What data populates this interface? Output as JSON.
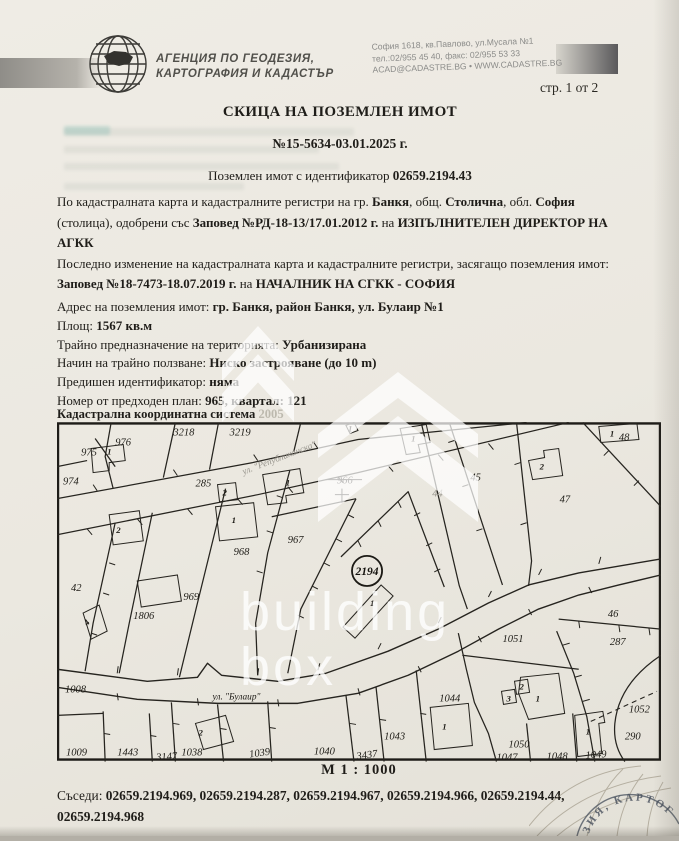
{
  "header": {
    "agency_line1": "АГЕНЦИЯ ПО ГЕОДЕЗИЯ,",
    "agency_line2": "КАРТОГРАФИЯ И КАДАСТЪР",
    "address_line1": "София 1618, кв.Павлово, ул.Мусала №1",
    "address_line2": "тел.:02/955 45 40, факс: 02/955 53 33",
    "address_line3": "ACAD@CADASTRE.BG • WWW.CADASTRE.BG",
    "page_indicator": "стр. 1 от 2"
  },
  "title": {
    "main": "СКИЦА НА ПОЗЕМЛЕН ИМОТ",
    "number": "№15-5634-03.01.2025 г.",
    "id_label": "Поземлен имот с идентификатор ",
    "id_value": "02659.2194.43"
  },
  "details": {
    "p1": [
      {
        "t": "По кадастралната карта и кадастралните регистри на гр. "
      },
      {
        "t": "Банкя"
      },
      {
        "t": ", общ. "
      },
      {
        "t": "Столична"
      },
      {
        "t": ", обл. "
      },
      {
        "t": "София"
      },
      {
        "t": " (столица), одобрени със "
      },
      {
        "t": "Заповед №РД-18-13/17.01.2012 г."
      },
      {
        "t": " на "
      },
      {
        "t": "ИЗПЪЛНИТЕЛЕН ДИРЕКТОР НА АГКК"
      }
    ],
    "p2": [
      {
        "t": "Последно изменение на кадастралната карта и кадастралните регистри, засягащо поземления имот: "
      },
      {
        "t": "Заповед №18-7473-18.07.2019 г."
      },
      {
        "t": " на "
      },
      {
        "t": "НАЧАЛНИК НА СГКК - СОФИЯ"
      }
    ],
    "rows": [
      {
        "label": "Адрес на поземления имот: ",
        "value": "гр. Банкя, район Банкя, ул. Булаир №1"
      },
      {
        "label": "Площ: ",
        "value": "1567 кв.м"
      },
      {
        "label": "Трайно предназначение на територията: ",
        "value": "Урбанизирана"
      },
      {
        "label": "Начин на трайно ползване: ",
        "value": "Ниско застрояване (до 10 m)"
      },
      {
        "label": "Предишен идентификатор: ",
        "value": "няма"
      },
      {
        "label": "Номер от предходен план: ",
        "value": "965, квартал: 121"
      }
    ]
  },
  "map": {
    "coord_system_label": "Кадастрална координатна система ",
    "coord_system_value": "2005",
    "scale": "М 1 : 1000",
    "subject_parcel": "2194",
    "labels": [
      {
        "t": "3218",
        "x": 116,
        "y": 13
      },
      {
        "t": "3219",
        "x": 172,
        "y": 13
      },
      {
        "t": "975",
        "x": 24,
        "y": 33
      },
      {
        "t": "976",
        "x": 58,
        "y": 23
      },
      {
        "t": "974",
        "x": 6,
        "y": 62
      },
      {
        "t": "285",
        "x": 138,
        "y": 64
      },
      {
        "t": "966",
        "x": 279,
        "y": 61
      },
      {
        "t": "44",
        "x": 374,
        "y": 74,
        "c": "f"
      },
      {
        "t": "45",
        "x": 412,
        "y": 58
      },
      {
        "t": "47",
        "x": 501,
        "y": 80
      },
      {
        "t": "48",
        "x": 560,
        "y": 18
      },
      {
        "t": "967",
        "x": 230,
        "y": 120
      },
      {
        "t": "968",
        "x": 176,
        "y": 132
      },
      {
        "t": "969",
        "x": 126,
        "y": 177
      },
      {
        "t": "1806",
        "x": 76,
        "y": 196
      },
      {
        "t": "1051",
        "x": 444,
        "y": 219
      },
      {
        "t": "46",
        "x": 549,
        "y": 194
      },
      {
        "t": "287",
        "x": 551,
        "y": 222
      },
      {
        "t": "1044",
        "x": 381,
        "y": 278
      },
      {
        "t": "1043",
        "x": 326,
        "y": 316
      },
      {
        "t": "1050",
        "x": 450,
        "y": 324
      },
      {
        "t": "1047",
        "x": 438,
        "y": 337
      },
      {
        "t": "1048",
        "x": 488,
        "y": 336
      },
      {
        "t": "1049",
        "x": 527,
        "y": 335,
        "r": -4
      },
      {
        "t": "1052",
        "x": 570,
        "y": 289
      },
      {
        "t": "290",
        "x": 566,
        "y": 316
      },
      {
        "t": "1008",
        "x": 8,
        "y": 269
      },
      {
        "t": "42",
        "x": 14,
        "y": 168
      },
      {
        "t": "1009",
        "x": 9,
        "y": 332
      },
      {
        "t": "1443",
        "x": 60,
        "y": 332
      },
      {
        "t": "3147",
        "x": 99,
        "y": 337,
        "r": -4
      },
      {
        "t": "1038",
        "x": 124,
        "y": 332
      },
      {
        "t": "1039",
        "x": 192,
        "y": 334,
        "r": -8
      },
      {
        "t": "1040",
        "x": 256,
        "y": 331
      },
      {
        "t": "3437",
        "x": 299,
        "y": 336,
        "r": -8
      },
      {
        "t": "ул. \"Булаир\"",
        "x": 155,
        "y": 276,
        "c": "s",
        "n": "street-label-bulair"
      },
      {
        "t": "ул. \"Републиканска\"",
        "x": 186,
        "y": 52,
        "c": "s f",
        "r": -21,
        "n": "street-label-republikanska"
      },
      {
        "t": "1",
        "x": 50,
        "y": 32,
        "c": "b",
        "n": "building-label"
      },
      {
        "t": "1",
        "x": 228,
        "y": 63,
        "c": "b",
        "n": "building-label"
      },
      {
        "t": "2",
        "x": 165,
        "y": 73,
        "c": "b",
        "n": "building-label"
      },
      {
        "t": "1",
        "x": 174,
        "y": 100,
        "c": "b",
        "n": "building-label"
      },
      {
        "t": "1",
        "x": 290,
        "y": 9,
        "c": "b",
        "n": "building-label"
      },
      {
        "t": "1",
        "x": 353,
        "y": 19,
        "c": "b",
        "n": "building-label"
      },
      {
        "t": "1",
        "x": 551,
        "y": 14,
        "c": "b",
        "n": "building-label"
      },
      {
        "t": "2",
        "x": 481,
        "y": 47,
        "c": "b",
        "n": "building-label"
      },
      {
        "t": "1",
        "x": 312,
        "y": 183,
        "c": "b",
        "n": "building-label"
      },
      {
        "t": "2",
        "x": 59,
        "y": 110,
        "c": "b",
        "n": "building-label"
      },
      {
        "t": "4",
        "x": 30,
        "y": 203,
        "c": "b",
        "r": -45,
        "n": "building-label"
      },
      {
        "t": "2",
        "x": 141,
        "y": 312,
        "c": "b",
        "n": "building-label"
      },
      {
        "t": "1",
        "x": 384,
        "y": 306,
        "c": "b",
        "n": "building-label"
      },
      {
        "t": "3",
        "x": 448,
        "y": 278,
        "c": "b",
        "n": "building-label"
      },
      {
        "t": "2",
        "x": 461,
        "y": 266,
        "c": "b",
        "n": "building-label"
      },
      {
        "t": "1",
        "x": 477,
        "y": 278,
        "c": "b",
        "n": "building-label"
      },
      {
        "t": "1",
        "x": 527,
        "y": 311,
        "c": "b",
        "n": "building-label"
      }
    ]
  },
  "watermark": {
    "line1": "building",
    "line2": "box"
  },
  "neighbors": {
    "label": "Съседи: ",
    "line1": "02659.2194.969, 02659.2194.287, 02659.2194.967, 02659.2194.966, 02659.2194.44,",
    "line2": "02659.2194.968"
  },
  "stamp": {
    "text": "ЗИЯ, КАРТОГ"
  }
}
